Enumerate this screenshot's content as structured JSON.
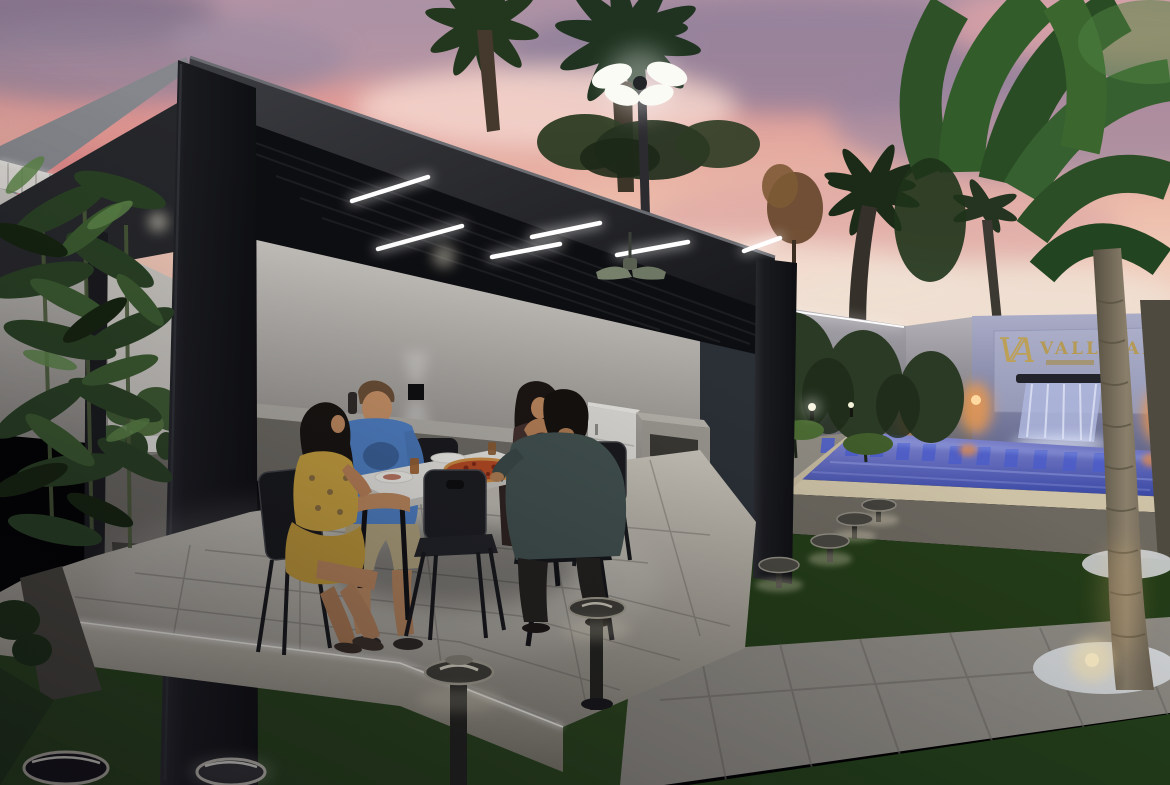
{
  "scene": {
    "logo": {
      "monogram": "VA",
      "name": "VALLE ALTO"
    },
    "elements": {
      "pergola": "black louvered pergola with linear LED lights and ceiling fan",
      "dining": "four people at outdoor dining table with pizza",
      "pool": "illuminated blue pool with waterfall feature wall",
      "lighting": "bollard mushroom lights, ground ring lights, palm uplights",
      "vegetation": "palm trees, bamboo, ficus trees, lawn"
    },
    "palette": {
      "sky_pink": "#e8a49d",
      "sky_violet": "#8d7f9b",
      "pergola_black": "#1b1c1f",
      "led_white": "#ffffff",
      "pool_blue": "#4a57b4",
      "grass_green": "#2e4a1f",
      "deck_stone": "#b5b0a5",
      "logo_gold": "#b59a55",
      "accent_orange": "#e8833a"
    }
  }
}
